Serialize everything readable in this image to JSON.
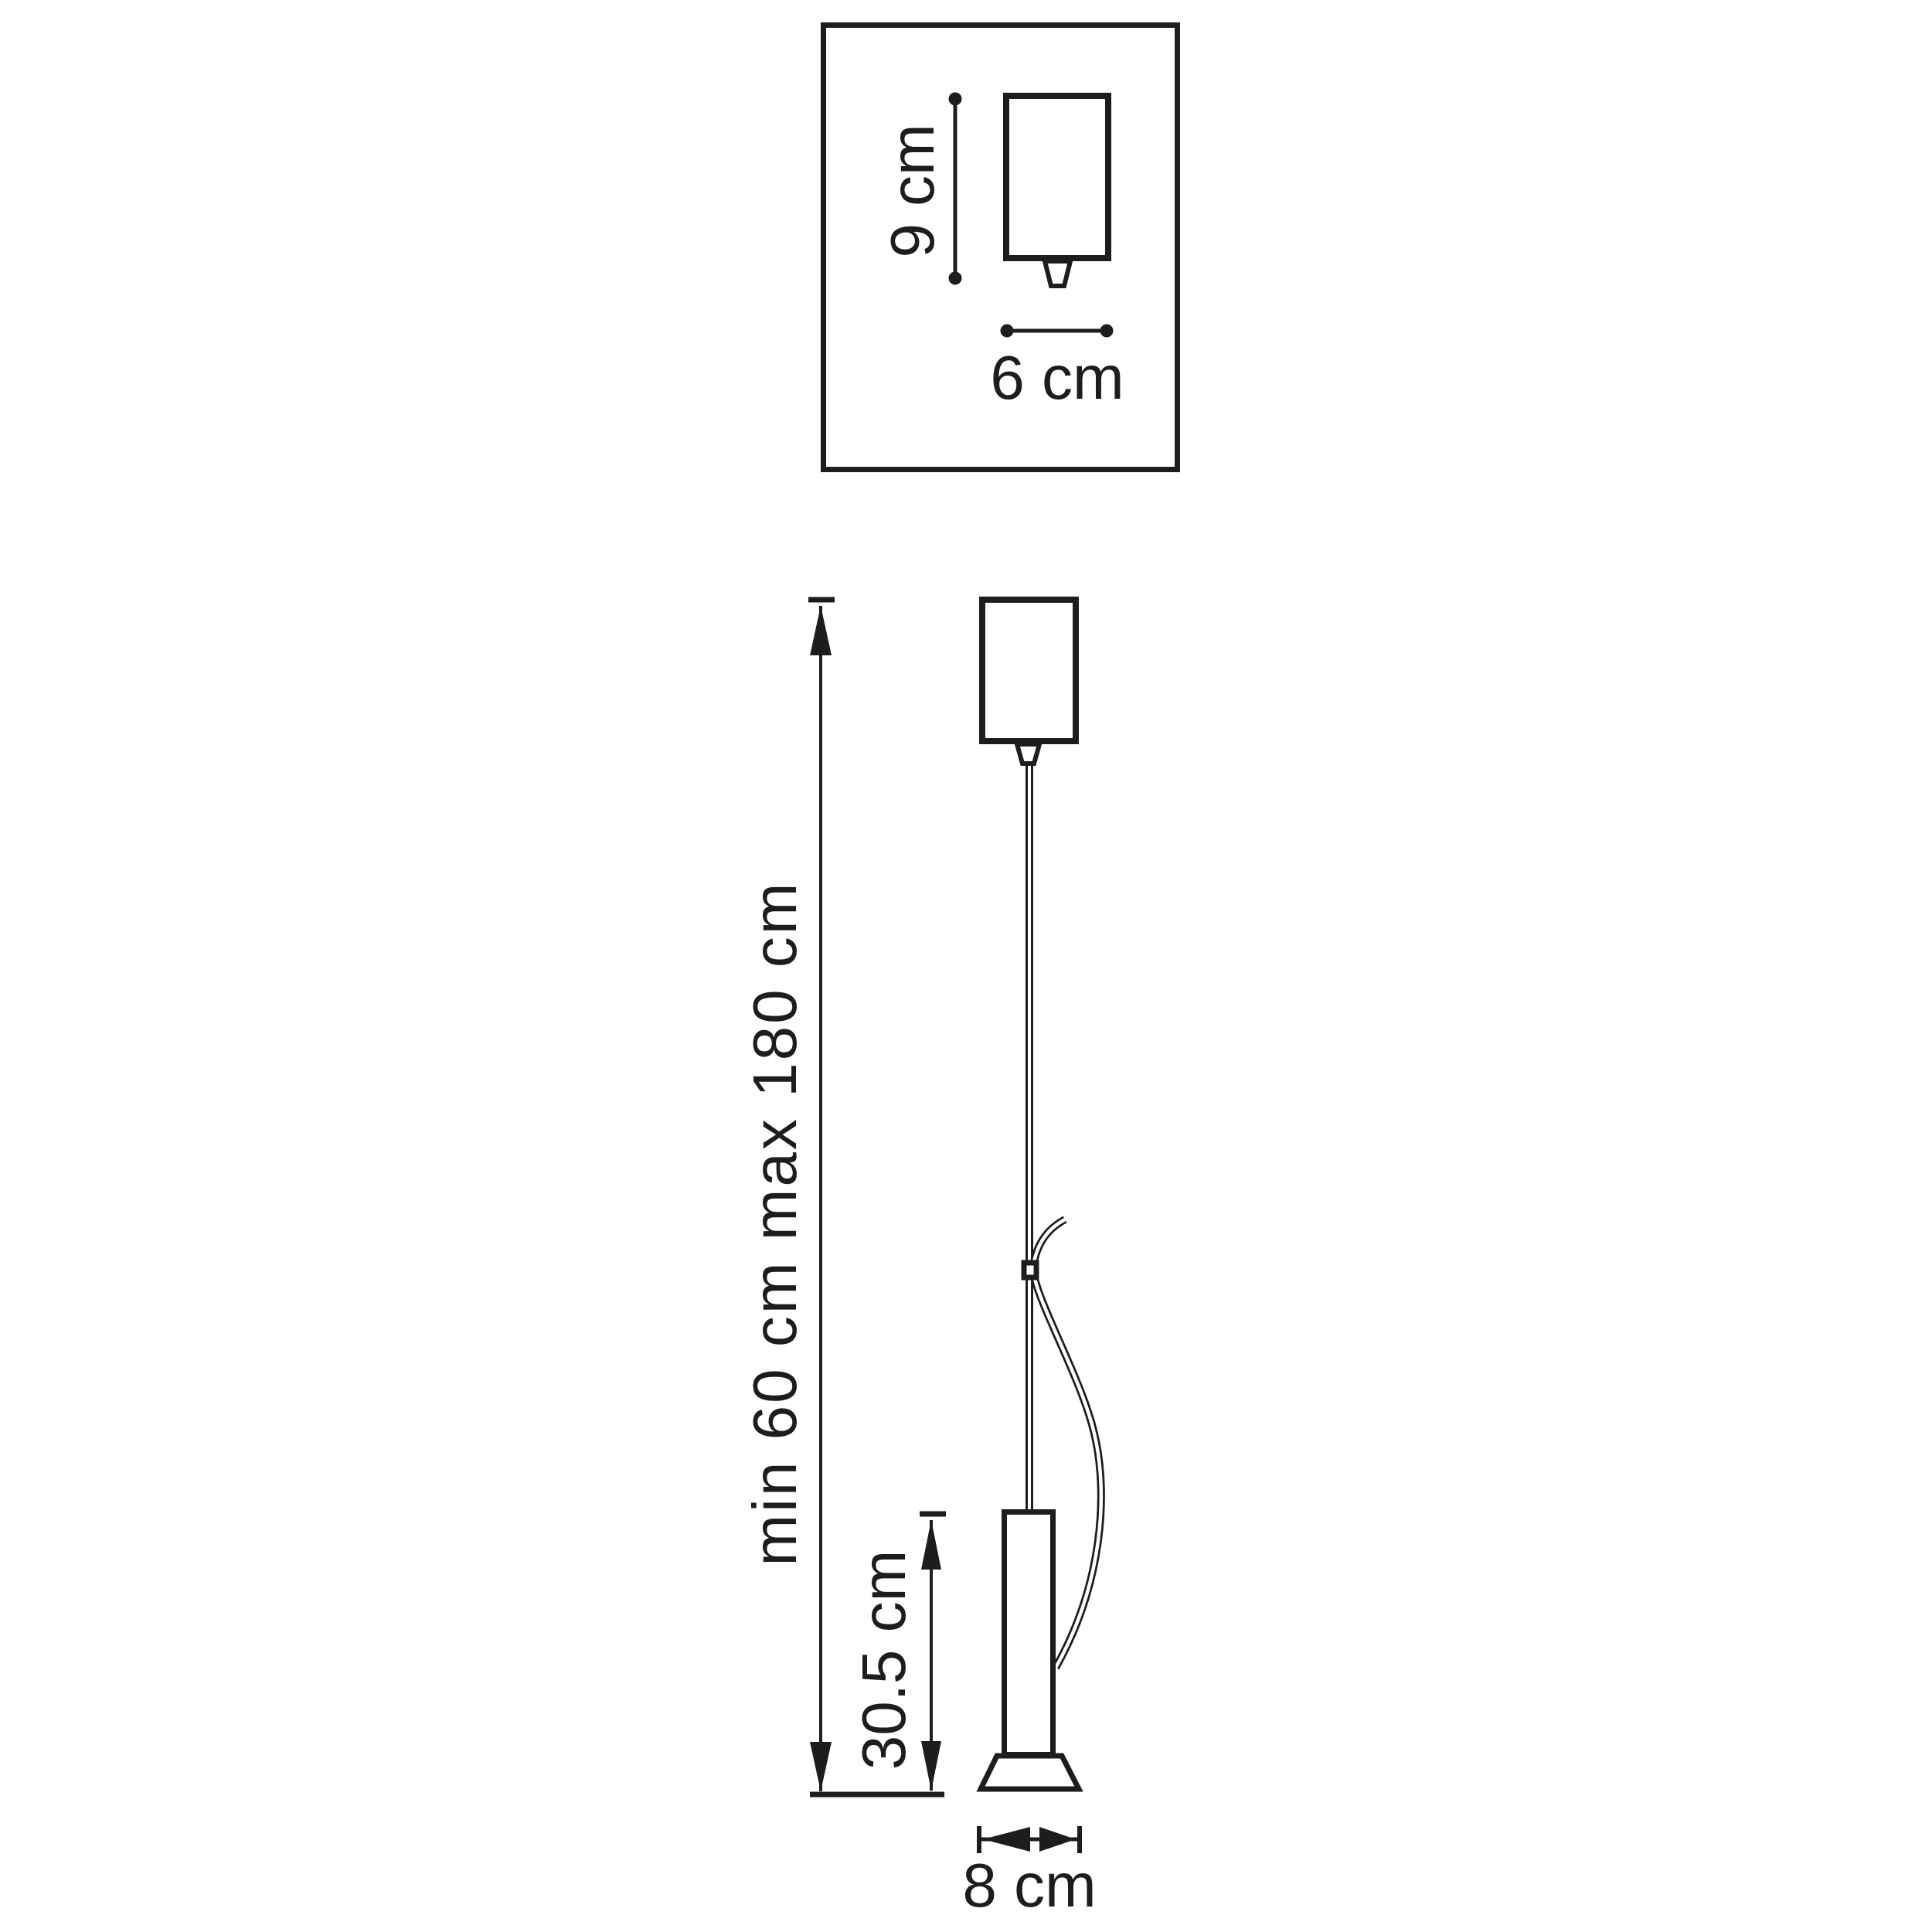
{
  "diagram": {
    "type": "pendant-lamp-dimension-drawing",
    "colors": {
      "line": "#1d1d1b",
      "background": "#ffffff"
    },
    "top_view": {
      "height_label": "9 cm",
      "width_label": "6 cm"
    },
    "front_view": {
      "suspension_label": "min 60 cm max 180 cm",
      "body_height_label": "30.5 cm",
      "base_width_label": "8 cm"
    }
  }
}
